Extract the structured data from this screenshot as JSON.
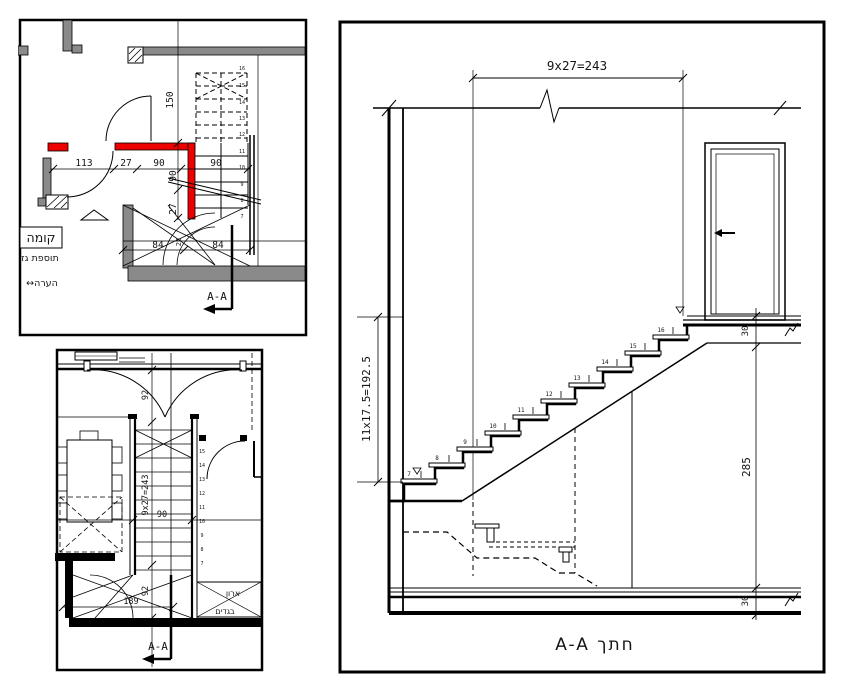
{
  "colors": {
    "wall_gray": "#8a8a8a",
    "wall_red": "#ee0000",
    "line": "#000000",
    "background": "#ffffff"
  },
  "upper_plan": {
    "title_box": "קומה",
    "subtitle": "תוספת גז",
    "note": "↔הערה",
    "section_mark": "A-A",
    "dims": {
      "w113": "113",
      "w27": "27",
      "w90a": "90",
      "w90b": "90",
      "h150": "150",
      "h90": "90",
      "h27": "27",
      "b84a": "84",
      "b84b": "84",
      "b25": "25"
    },
    "steps": [
      "16",
      "15",
      "14",
      "13",
      "12",
      "11",
      "10",
      "9",
      "8",
      "7"
    ]
  },
  "lower_plan": {
    "dims": {
      "d92top": "92",
      "run": "9x27=243",
      "w90": "90",
      "d189": "189",
      "d92mid": "92"
    },
    "closet_label_1": "ארון",
    "closet_label_2": "בגדים",
    "section_mark": "A-A",
    "steps": [
      "16",
      "15",
      "14",
      "13",
      "12",
      "11",
      "10",
      "9",
      "8",
      "7"
    ]
  },
  "section": {
    "dims": {
      "run": "9x27=243",
      "rise": "11x17.5=192.5",
      "height": "285",
      "slab_top": "30",
      "slab_bottom": "30"
    },
    "title": "A-A  חתך",
    "steps": [
      "7",
      "8",
      "9",
      "10",
      "11",
      "12",
      "13",
      "14",
      "15",
      "16"
    ]
  }
}
